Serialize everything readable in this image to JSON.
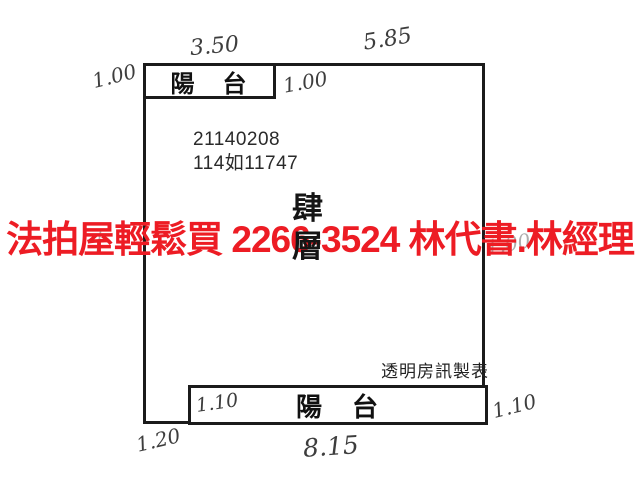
{
  "floorplan": {
    "case_number": "21140208",
    "case_reference": "114如11747",
    "floor_label": "肆層",
    "balcony_top_label": "陽　台",
    "balcony_bottom_label": "陽　台",
    "publisher_label": "透明房訊製表",
    "dimensions": {
      "top_left_width": "3.50",
      "top_right_width": "5.85",
      "left_outer_height": "1.00",
      "inner_top_height": "1.00",
      "bottom_balcony_left": "1.10",
      "bottom_right_height": "1.10",
      "bottom_left_height": "1.20",
      "bottom_width": "8.15",
      "obscured_left_fragment": "/",
      "obscured_right_fragment": "1.00"
    }
  },
  "watermark": {
    "text": "法拍屋輕鬆買  2266-3524  林代書.林經理",
    "color": "#ed1c24"
  },
  "colors": {
    "line": "#1b1b1b",
    "printed_text": "#2a2a2a",
    "handwriting": "#3d3d3d",
    "background": "#ffffff"
  }
}
